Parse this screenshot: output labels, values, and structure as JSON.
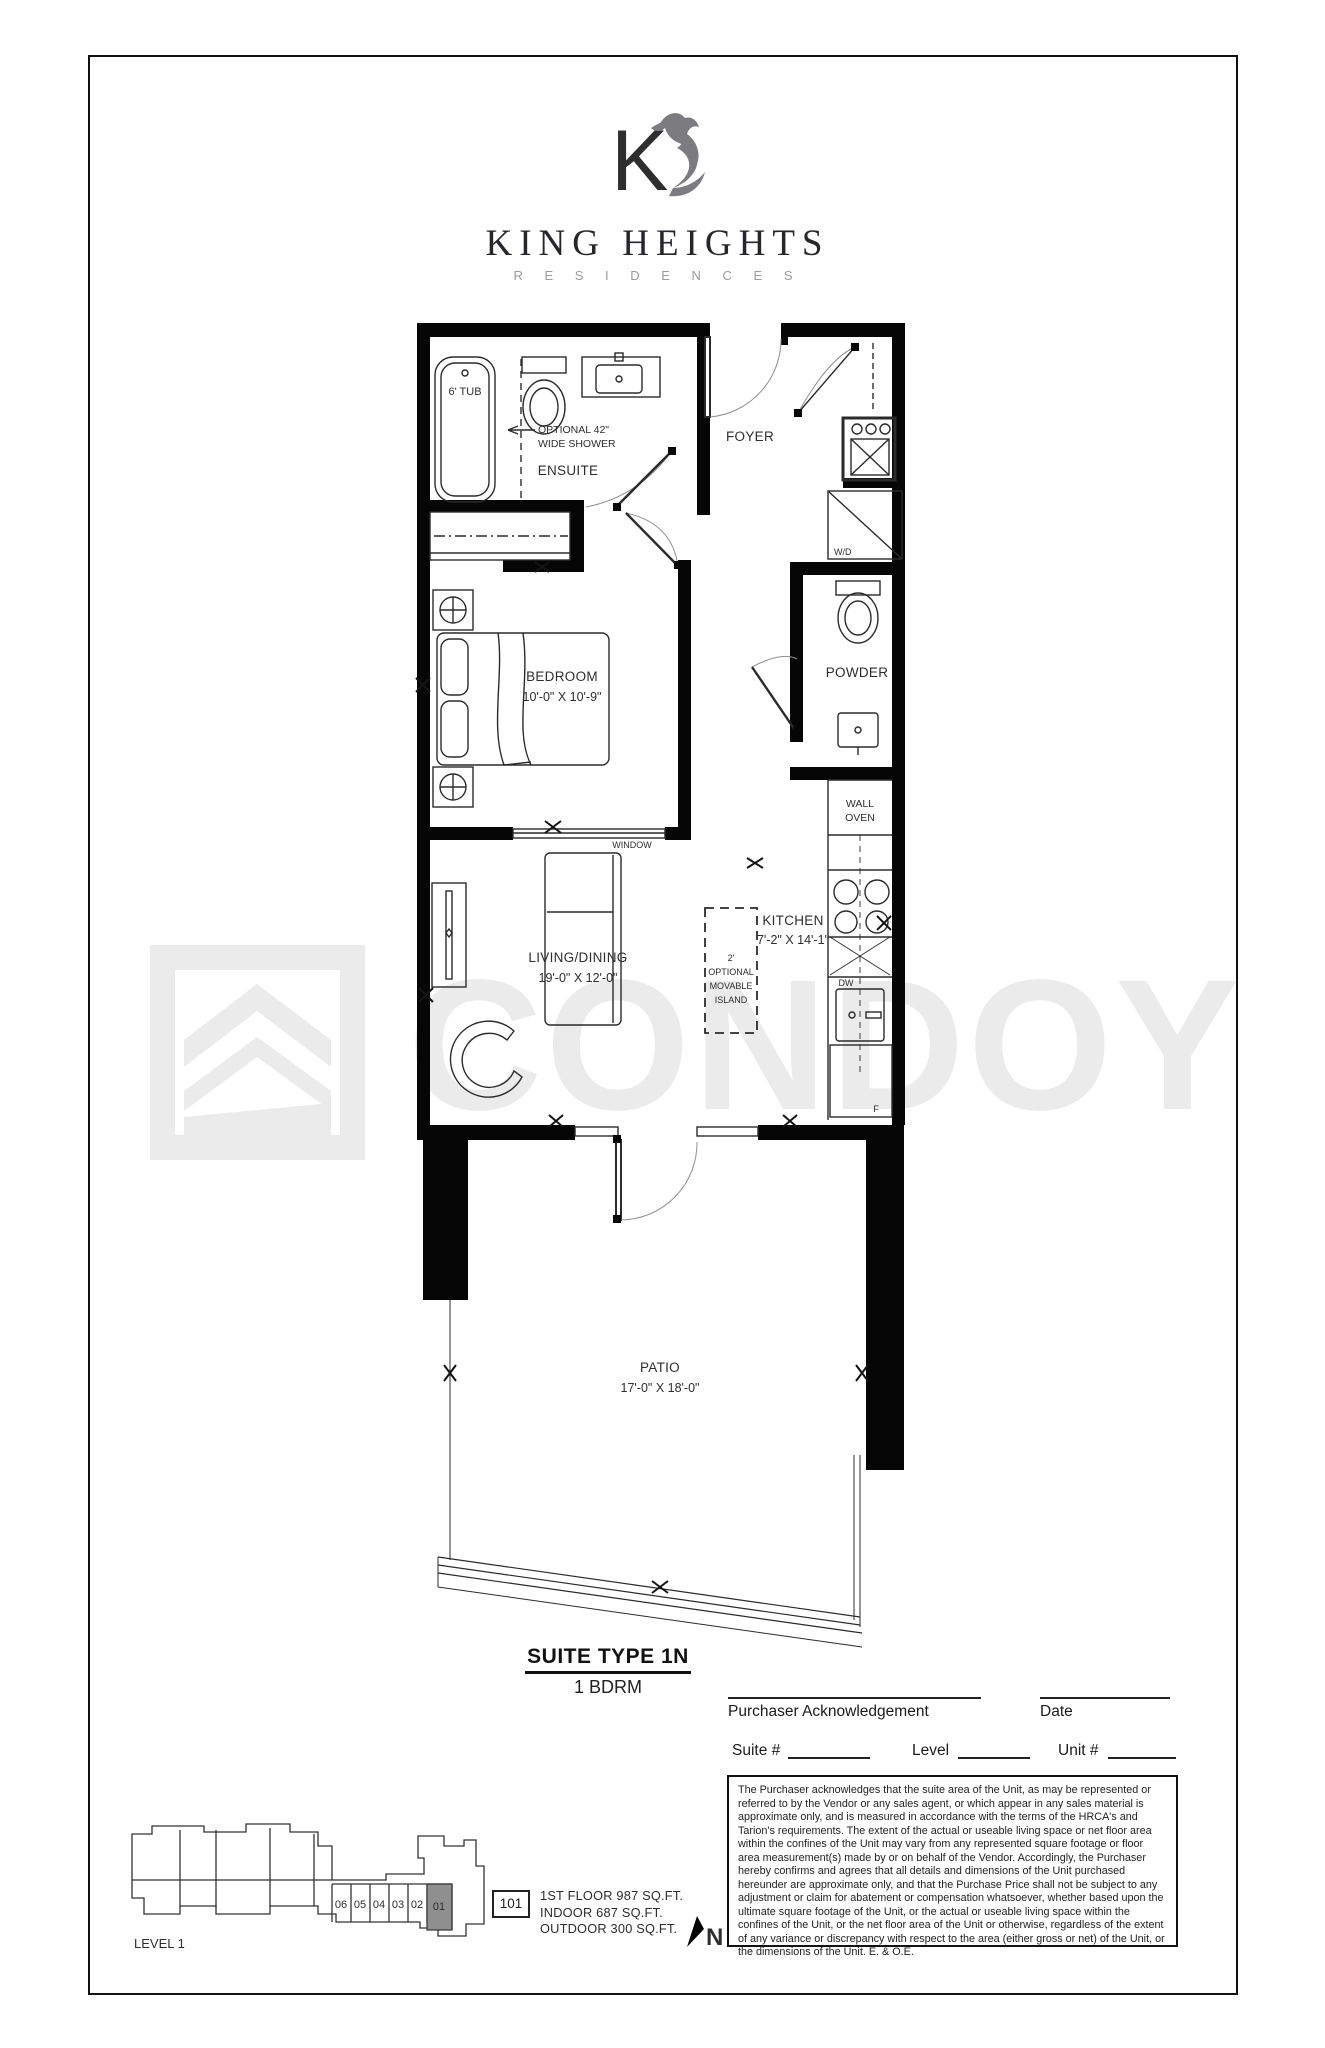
{
  "brand": {
    "monogram": "K",
    "name": "KING HEIGHTS",
    "tagline": "R E S I D E N C E S"
  },
  "watermark": {
    "text": "CONDOY",
    "logo": "chevron-roof-logo"
  },
  "plan": {
    "ensuite": {
      "label": "ENSUITE",
      "tub": "6' TUB",
      "shower_note_line1": "OPTIONAL 42\"",
      "shower_note_line2": "WIDE SHOWER"
    },
    "foyer": {
      "label": "FOYER"
    },
    "laundry": {
      "wd": "W/D"
    },
    "bedroom": {
      "label": "BEDROOM",
      "dims": "10'-0\" X 10'-9\"",
      "window": "WINDOW"
    },
    "powder": {
      "label": "POWDER"
    },
    "kitchen": {
      "label": "KITCHEN",
      "dims": "7'-2\" X 14'-1\"",
      "wall_oven_line1": "WALL",
      "wall_oven_line2": "OVEN",
      "dw": "DW",
      "fridge": "F"
    },
    "island": {
      "line1": "2'",
      "line2": "OPTIONAL",
      "line3": "MOVABLE",
      "line4": "ISLAND"
    },
    "living": {
      "label": "LIVING/DINING",
      "dims": "19'-0\" X 12'-0\""
    },
    "patio": {
      "label": "PATIO",
      "dims": "17'-0\" X 18'-0\""
    }
  },
  "suite": {
    "title": "SUITE TYPE 1N",
    "subtitle": "1 BDRM"
  },
  "signature": {
    "purchaser_label": "Purchaser Acknowledgement",
    "date_label": "Date",
    "suite_label": "Suite #",
    "level_label": "Level",
    "unit_label": "Unit #"
  },
  "legal": {
    "text": "The Purchaser acknowledges that the suite area of the Unit, as may be represented or referred to by the Vendor or any sales agent, or which appear in any sales material is approximate only, and is measured in accordance with the terms of the HRCA's and Tarion's requirements.  The extent of the actual or useable living space or net floor area within the confines of the Unit may vary from any represented square footage or floor area measurement(s) made by or on behalf of the Vendor.  Accordingly, the Purchaser hereby confirms and agrees that all details and dimensions of the Unit purchased hereunder are approximate only, and that the Purchase Price shall not be subject to any adjustment or claim for abatement or compensation whatsoever, whether based upon the ultimate square footage of the Unit, or the actual or useable living space within the confines of the Unit, or the net floor area of the Unit or otherwise, regardless of the extent of any variance or discrepancy with respect to the area (either gross or net) of the Unit, or the dimensions of the Unit. E. & O.E."
  },
  "keyplan": {
    "level_label": "LEVEL 1",
    "units": [
      "06",
      "05",
      "04",
      "03",
      "02",
      "01"
    ],
    "highlighted_unit": "01"
  },
  "unit_info": {
    "number": "101",
    "area_line1": "1ST FLOOR 987 SQ.FT.",
    "area_line2": "INDOOR 687 SQ.FT.",
    "area_line3": "OUTDOOR 300 SQ.FT."
  },
  "north": {
    "label": "N"
  },
  "colors": {
    "wall": "#060606",
    "line": "#2b2b2b",
    "label": "#2e2e2e",
    "watermark": "#ebebeb",
    "brand_gray": "#8b8b90",
    "keyplan_highlight": "#8f8f8f"
  }
}
